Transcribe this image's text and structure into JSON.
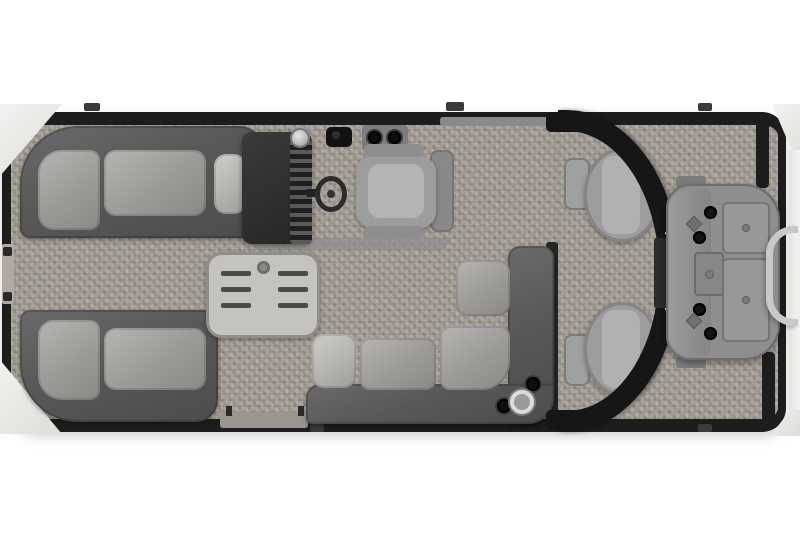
{
  "scene": {
    "type": "pontoon-boat-floorplan-top-view",
    "brand_label": "PREMIER",
    "components": [
      "bow-boarding-gate",
      "port-bow-lounge",
      "starboard-bow-lounge",
      "helm-console",
      "steering-wheel",
      "captain-chair",
      "cocktail-table",
      "midship-l-lounge",
      "side-boarding-gate",
      "ski-arch",
      "aft-recliner-port",
      "aft-recliner-starboard",
      "outboard-motor",
      "stern-grab-handle"
    ],
    "colors": {
      "background": "#ffffff",
      "carpet": "#a49e96",
      "rail": "#1d1d1d",
      "couch": "#585858",
      "cushion": "#9c9a97",
      "cushionlight": "#b3b1ae",
      "console": "#262626",
      "table": "#c5c3bf",
      "slat": "#4a4a48",
      "arch": "#161616",
      "archtext": "#ffffff",
      "motor": "#8e8e8e",
      "platform": "#f2f2f0",
      "ladder": "#c8c8c8",
      "chair": "#9d9d9d"
    }
  }
}
